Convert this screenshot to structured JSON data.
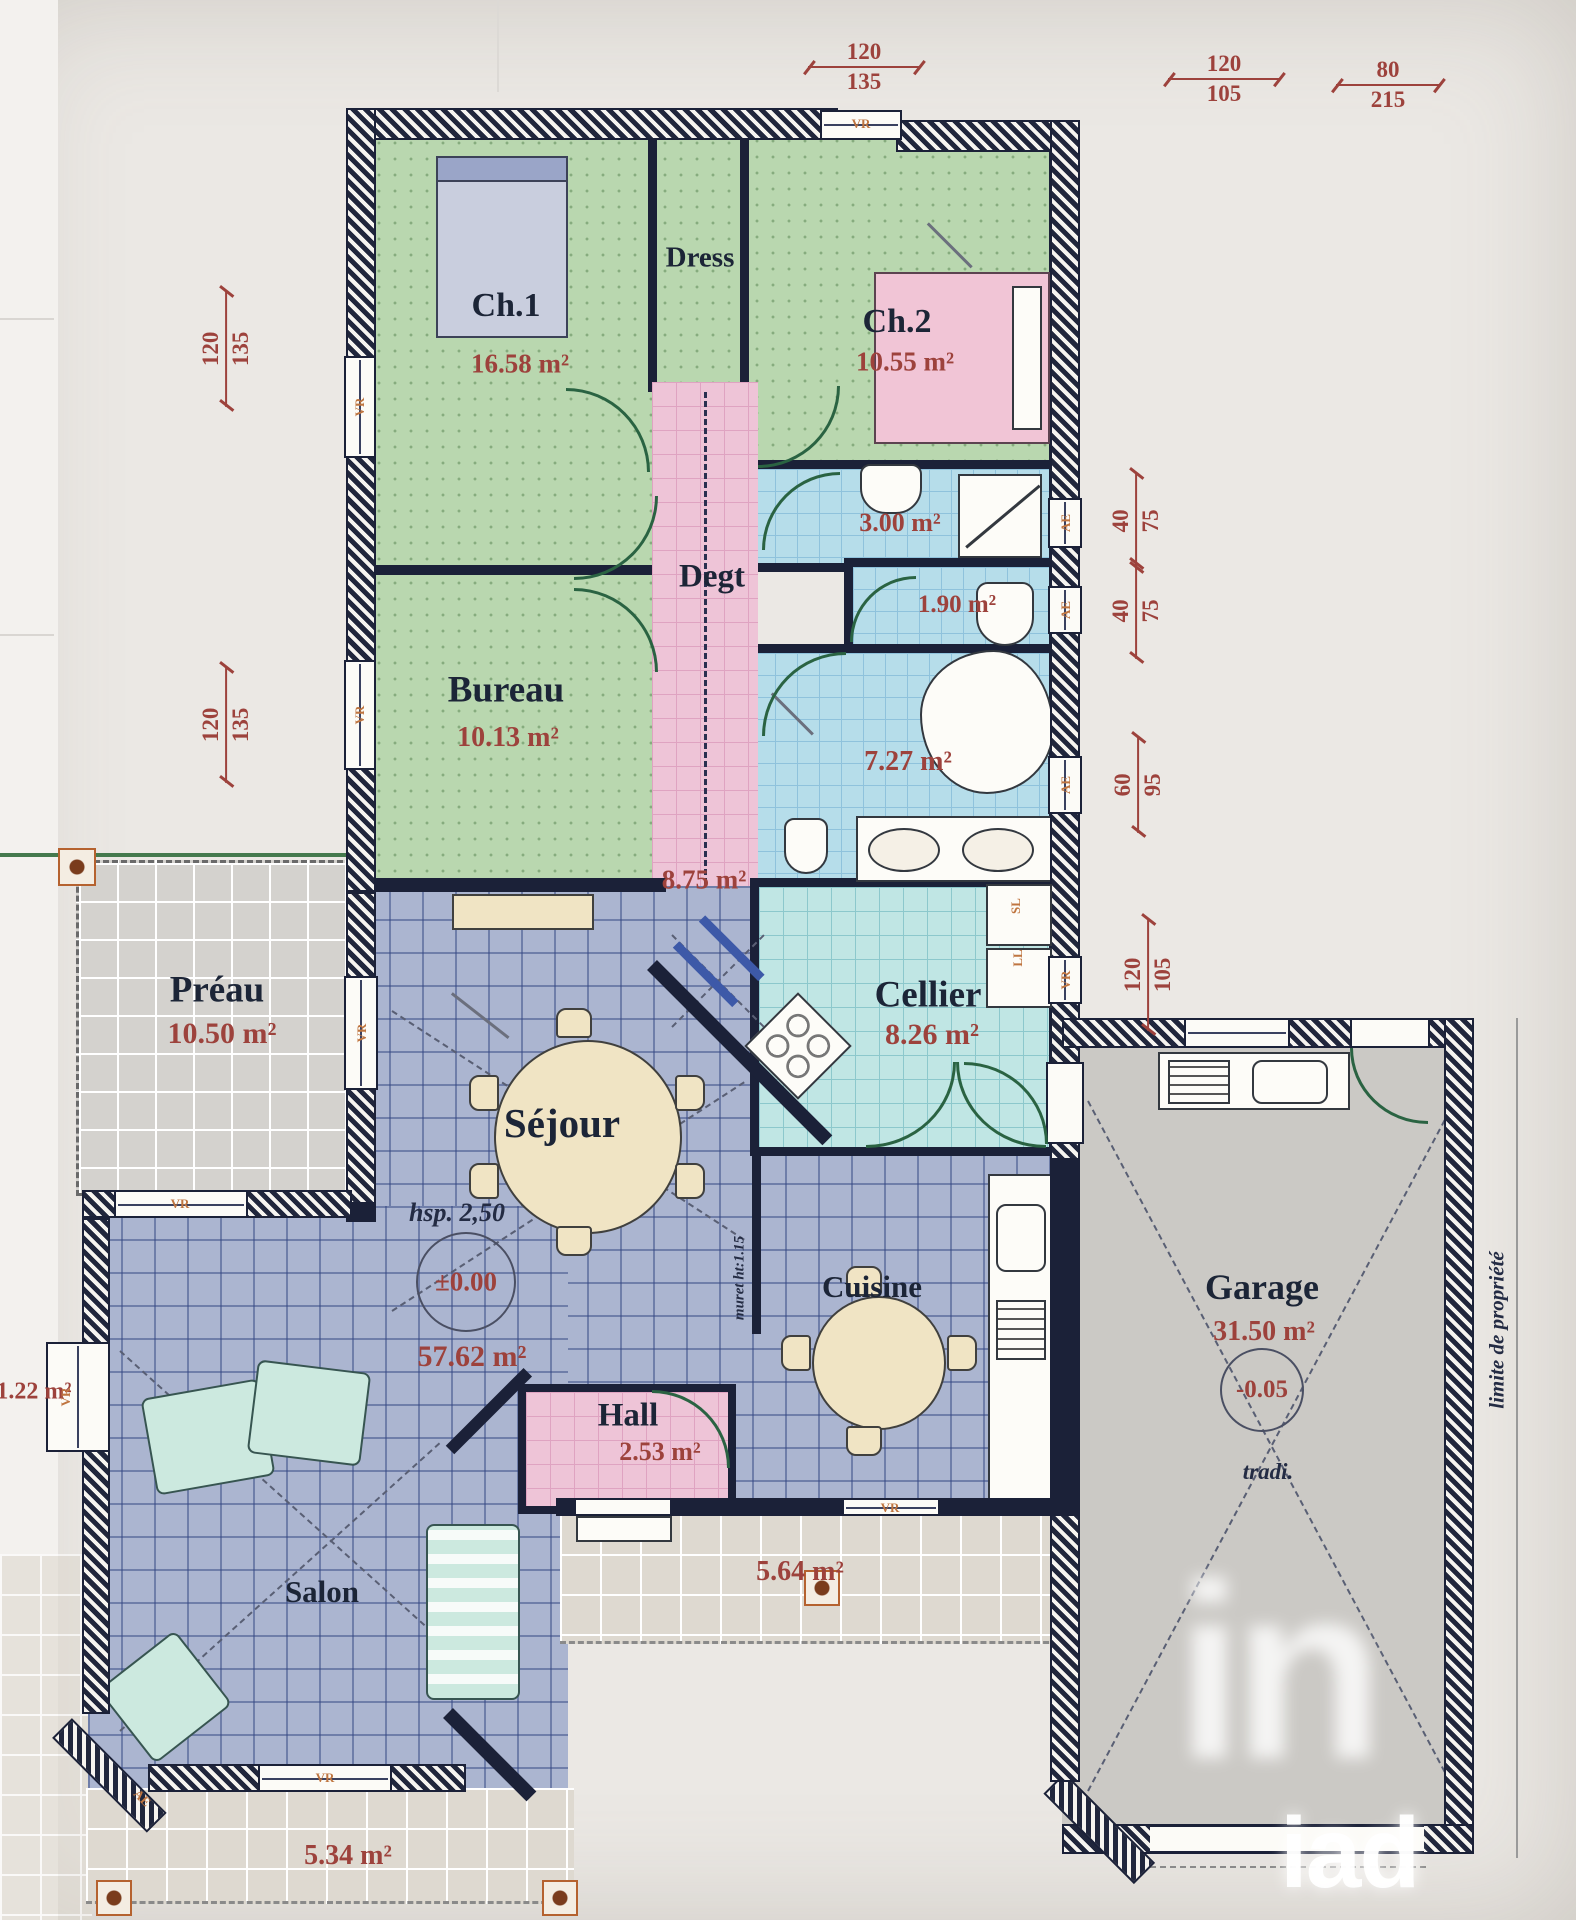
{
  "rooms": {
    "ch1": {
      "label": "Ch.1",
      "area": "16.58 m²"
    },
    "dress": {
      "label": "Dress"
    },
    "ch2": {
      "label": "Ch.2",
      "area": "10.55 m²"
    },
    "shower": {
      "area": "3.00 m²"
    },
    "wc": {
      "area": "1.90 m²"
    },
    "degt": {
      "label": "Degt",
      "area": "8.75 m²"
    },
    "bureau": {
      "label": "Bureau",
      "area": "10.13 m²"
    },
    "bath": {
      "area": "7.27 m²"
    },
    "cellier": {
      "label": "Cellier",
      "area": "8.26 m²"
    },
    "preau": {
      "label": "Préau",
      "area": "10.50 m²"
    },
    "sejour": {
      "label": "Séjour",
      "area": "57.62 m²",
      "ceiling": "hsp. 2,50",
      "level": "±0.00"
    },
    "cuisine": {
      "label": "Cuisine"
    },
    "hall": {
      "label": "Hall",
      "area": "2.53 m²"
    },
    "salon": {
      "label": "Salon"
    },
    "garage": {
      "label": "Garage",
      "area": "31.50 m²",
      "level": "-0.05",
      "build": "tradi."
    },
    "terrace_front": {
      "area": "5.64 m²"
    },
    "terrace_sw": {
      "area": "5.34 m²"
    },
    "ledge_left": {
      "area": "1.22 m²"
    }
  },
  "dimensions": {
    "top_window": {
      "w": "120",
      "h": "135"
    },
    "garage_window": {
      "w": "120",
      "h": "105"
    },
    "garage_door": {
      "w": "80",
      "h": "215"
    },
    "left_window_1": {
      "w": "120",
      "h": "135"
    },
    "left_window_2": {
      "w": "120",
      "h": "135"
    },
    "right_window_1": {
      "w": "40",
      "h": "75"
    },
    "right_window_2": {
      "w": "40",
      "h": "75"
    },
    "right_window_3": {
      "w": "60",
      "h": "95"
    },
    "right_window_4": {
      "w": "120",
      "h": "105"
    }
  },
  "openings": {
    "roller_shutter": "VR",
    "awning": "AE"
  },
  "appliances": {
    "dryer": "SL",
    "washer": "LL"
  },
  "notes": {
    "low_wall": "muret ht:1.15",
    "property_limit": "limite de propriété"
  },
  "watermark": {
    "logo": "in",
    "brand": "iad"
  }
}
